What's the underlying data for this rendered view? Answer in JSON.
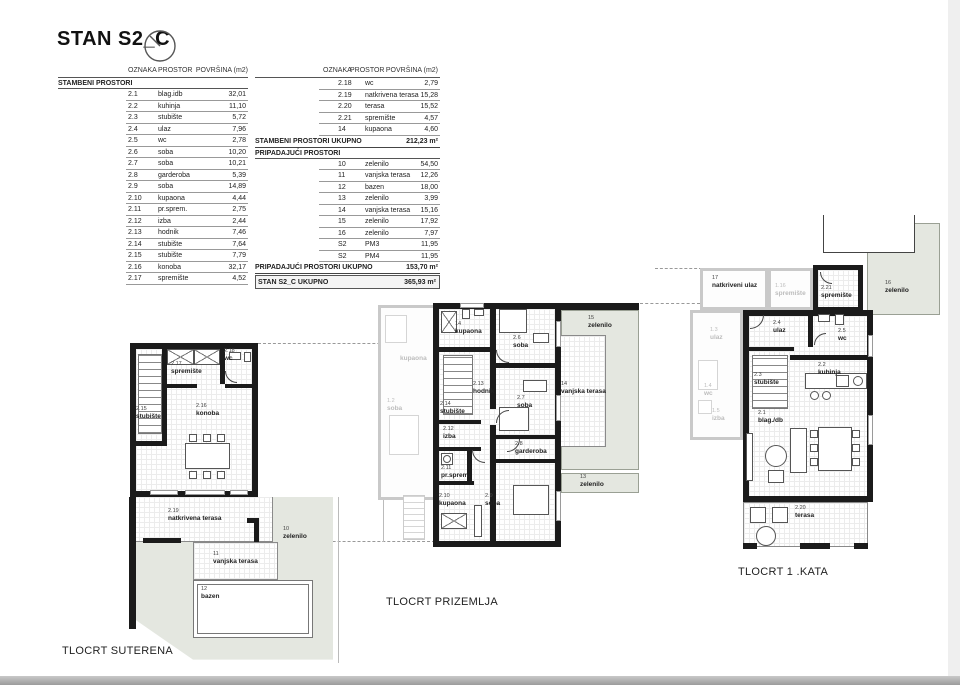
{
  "page": {
    "title": "STAN S2_C"
  },
  "columns": {
    "oznaka": "OZNAKA",
    "prostor": "PROSTOR",
    "povrsina": "POVRŠINA (m2)"
  },
  "left_table": {
    "section": "STAMBENI PROSTORI",
    "rows": [
      {
        "oznaka": "2.1",
        "prostor": "blag.idb",
        "povrsina": "32,01"
      },
      {
        "oznaka": "2.2",
        "prostor": "kuhinja",
        "povrsina": "11,10"
      },
      {
        "oznaka": "2.3",
        "prostor": "stubište",
        "povrsina": "5,72"
      },
      {
        "oznaka": "2.4",
        "prostor": "ulaz",
        "povrsina": "7,96"
      },
      {
        "oznaka": "2.5",
        "prostor": "wc",
        "povrsina": "2,78"
      },
      {
        "oznaka": "2.6",
        "prostor": "soba",
        "povrsina": "10,20"
      },
      {
        "oznaka": "2.7",
        "prostor": "soba",
        "povrsina": "10,21"
      },
      {
        "oznaka": "2.8",
        "prostor": "garderoba",
        "povrsina": "5,39"
      },
      {
        "oznaka": "2.9",
        "prostor": "soba",
        "povrsina": "14,89"
      },
      {
        "oznaka": "2.10",
        "prostor": "kupaona",
        "povrsina": "4,44"
      },
      {
        "oznaka": "2.11",
        "prostor": "pr.sprem.",
        "povrsina": "2,75"
      },
      {
        "oznaka": "2.12",
        "prostor": "izba",
        "povrsina": "2,44"
      },
      {
        "oznaka": "2.13",
        "prostor": "hodnik",
        "povrsina": "7,46"
      },
      {
        "oznaka": "2.14",
        "prostor": "stubište",
        "povrsina": "7,64"
      },
      {
        "oznaka": "2.15",
        "prostor": "stubište",
        "povrsina": "7,79"
      },
      {
        "oznaka": "2.16",
        "prostor": "konoba",
        "povrsina": "32,17"
      },
      {
        "oznaka": "2.17",
        "prostor": "spremište",
        "povrsina": "4,52"
      }
    ]
  },
  "right_table": {
    "rows_top": [
      {
        "oznaka": "2.18",
        "prostor": "wc",
        "povrsina": "2,79"
      },
      {
        "oznaka": "2.19",
        "prostor": "natkrivena terasa",
        "povrsina": "15,28"
      },
      {
        "oznaka": "2.20",
        "prostor": "terasa",
        "povrsina": "15,52"
      },
      {
        "oznaka": "2.21",
        "prostor": "spremište",
        "povrsina": "4,57"
      },
      {
        "oznaka": "14",
        "prostor": "kupaona",
        "povrsina": "4,60"
      }
    ],
    "stambeni_total": {
      "label": "STAMBENI PROSTORI UKUPNO",
      "value": "212,23 m²"
    },
    "section2": "PRIPADAJUĆI PROSTORI",
    "rows_bottom": [
      {
        "oznaka": "10",
        "prostor": "zelenilo",
        "povrsina": "54,50"
      },
      {
        "oznaka": "11",
        "prostor": "vanjska terasa",
        "povrsina": "12,26"
      },
      {
        "oznaka": "12",
        "prostor": "bazen",
        "povrsina": "18,00"
      },
      {
        "oznaka": "13",
        "prostor": "zelenilo",
        "povrsina": "3,99"
      },
      {
        "oznaka": "14",
        "prostor": "vanjska terasa",
        "povrsina": "15,16"
      },
      {
        "oznaka": "15",
        "prostor": "zelenilo",
        "povrsina": "17,92"
      },
      {
        "oznaka": "16",
        "prostor": "zelenilo",
        "povrsina": "7,97"
      },
      {
        "oznaka": "S2",
        "prostor": "PM3",
        "povrsina": "11,95"
      },
      {
        "oznaka": "S2",
        "prostor": "PM4",
        "povrsina": "11,95"
      }
    ],
    "pripadajuci_total": {
      "label": "PRIPADAJUĆI PROSTORI UKUPNO",
      "value": "153,70 m²"
    },
    "grand_total": {
      "label": "STAN S2_C UKUPNO",
      "value": "365,93 m²"
    }
  },
  "plans": {
    "suterena": {
      "title": "TLOCRT SUTERENA",
      "rooms": {
        "stubiste": {
          "code": "2.15",
          "name": "stubište"
        },
        "spremiste": {
          "code": "2.17",
          "name": "spremište"
        },
        "wc": {
          "code": "2.18",
          "name": "wc"
        },
        "konoba": {
          "code": "2.16",
          "name": "konoba"
        },
        "natkrivena_terasa": {
          "code": "2.19",
          "name": "natkrivena terasa"
        },
        "vanjska_terasa": {
          "code": "11",
          "name": "vanjska terasa"
        },
        "bazen": {
          "code": "12",
          "name": "bazen"
        },
        "zelenilo": {
          "code": "10",
          "name": "zelenilo"
        }
      }
    },
    "prizemlja": {
      "title": "TLOCRT PRIZEMLJA",
      "rooms": {
        "kupaona14": {
          "code": "14",
          "name": "kupaona"
        },
        "soba26": {
          "code": "2.6",
          "name": "soba"
        },
        "hodnik": {
          "code": "2.13",
          "name": "hodnik"
        },
        "stubiste": {
          "code": "2.14",
          "name": "stubište"
        },
        "izba": {
          "code": "2.12",
          "name": "izba"
        },
        "soba27": {
          "code": "2.7",
          "name": "soba"
        },
        "garderoba": {
          "code": "2.8",
          "name": "garderoba"
        },
        "prsprem": {
          "code": "2.11",
          "name": "pr.sprem."
        },
        "kupaona210": {
          "code": "2.10",
          "name": "kupaona"
        },
        "soba29": {
          "code": "2.9",
          "name": "soba"
        },
        "zelenilo15": {
          "code": "15",
          "name": "zelenilo"
        },
        "vanjska14": {
          "code": "14",
          "name": "vanjska terasa"
        },
        "zelenilo13": {
          "code": "13",
          "name": "zelenilo"
        },
        "faded_kupaona": {
          "code": "",
          "name": "kupaona"
        },
        "faded_soba": {
          "code": "1.2",
          "name": "soba"
        }
      }
    },
    "kata": {
      "title": "TLOCRT 1 .KATA",
      "rooms": {
        "natkriveni_ulaz": {
          "code": "17",
          "name": "natkriveni ulaz"
        },
        "spremiste116": {
          "code": "1.16",
          "name": "spremište"
        },
        "spremiste221": {
          "code": "2.21",
          "name": "spremište"
        },
        "zelenilo16": {
          "code": "16",
          "name": "zelenilo"
        },
        "ulaz": {
          "code": "2.4",
          "name": "ulaz"
        },
        "wc": {
          "code": "2.5",
          "name": "wc"
        },
        "kuhinja": {
          "code": "2.2",
          "name": "kuhinja"
        },
        "stubiste": {
          "code": "2.3",
          "name": "stubište"
        },
        "blagdb": {
          "code": "2.1",
          "name": "blag./db"
        },
        "terasa": {
          "code": "2.20",
          "name": "terasa"
        },
        "faded_ulaz": {
          "code": "1.3",
          "name": "ulaz"
        },
        "faded_wc": {
          "code": "1.4",
          "name": "wc"
        },
        "faded_izba": {
          "code": "1.5",
          "name": "izba"
        }
      }
    }
  }
}
